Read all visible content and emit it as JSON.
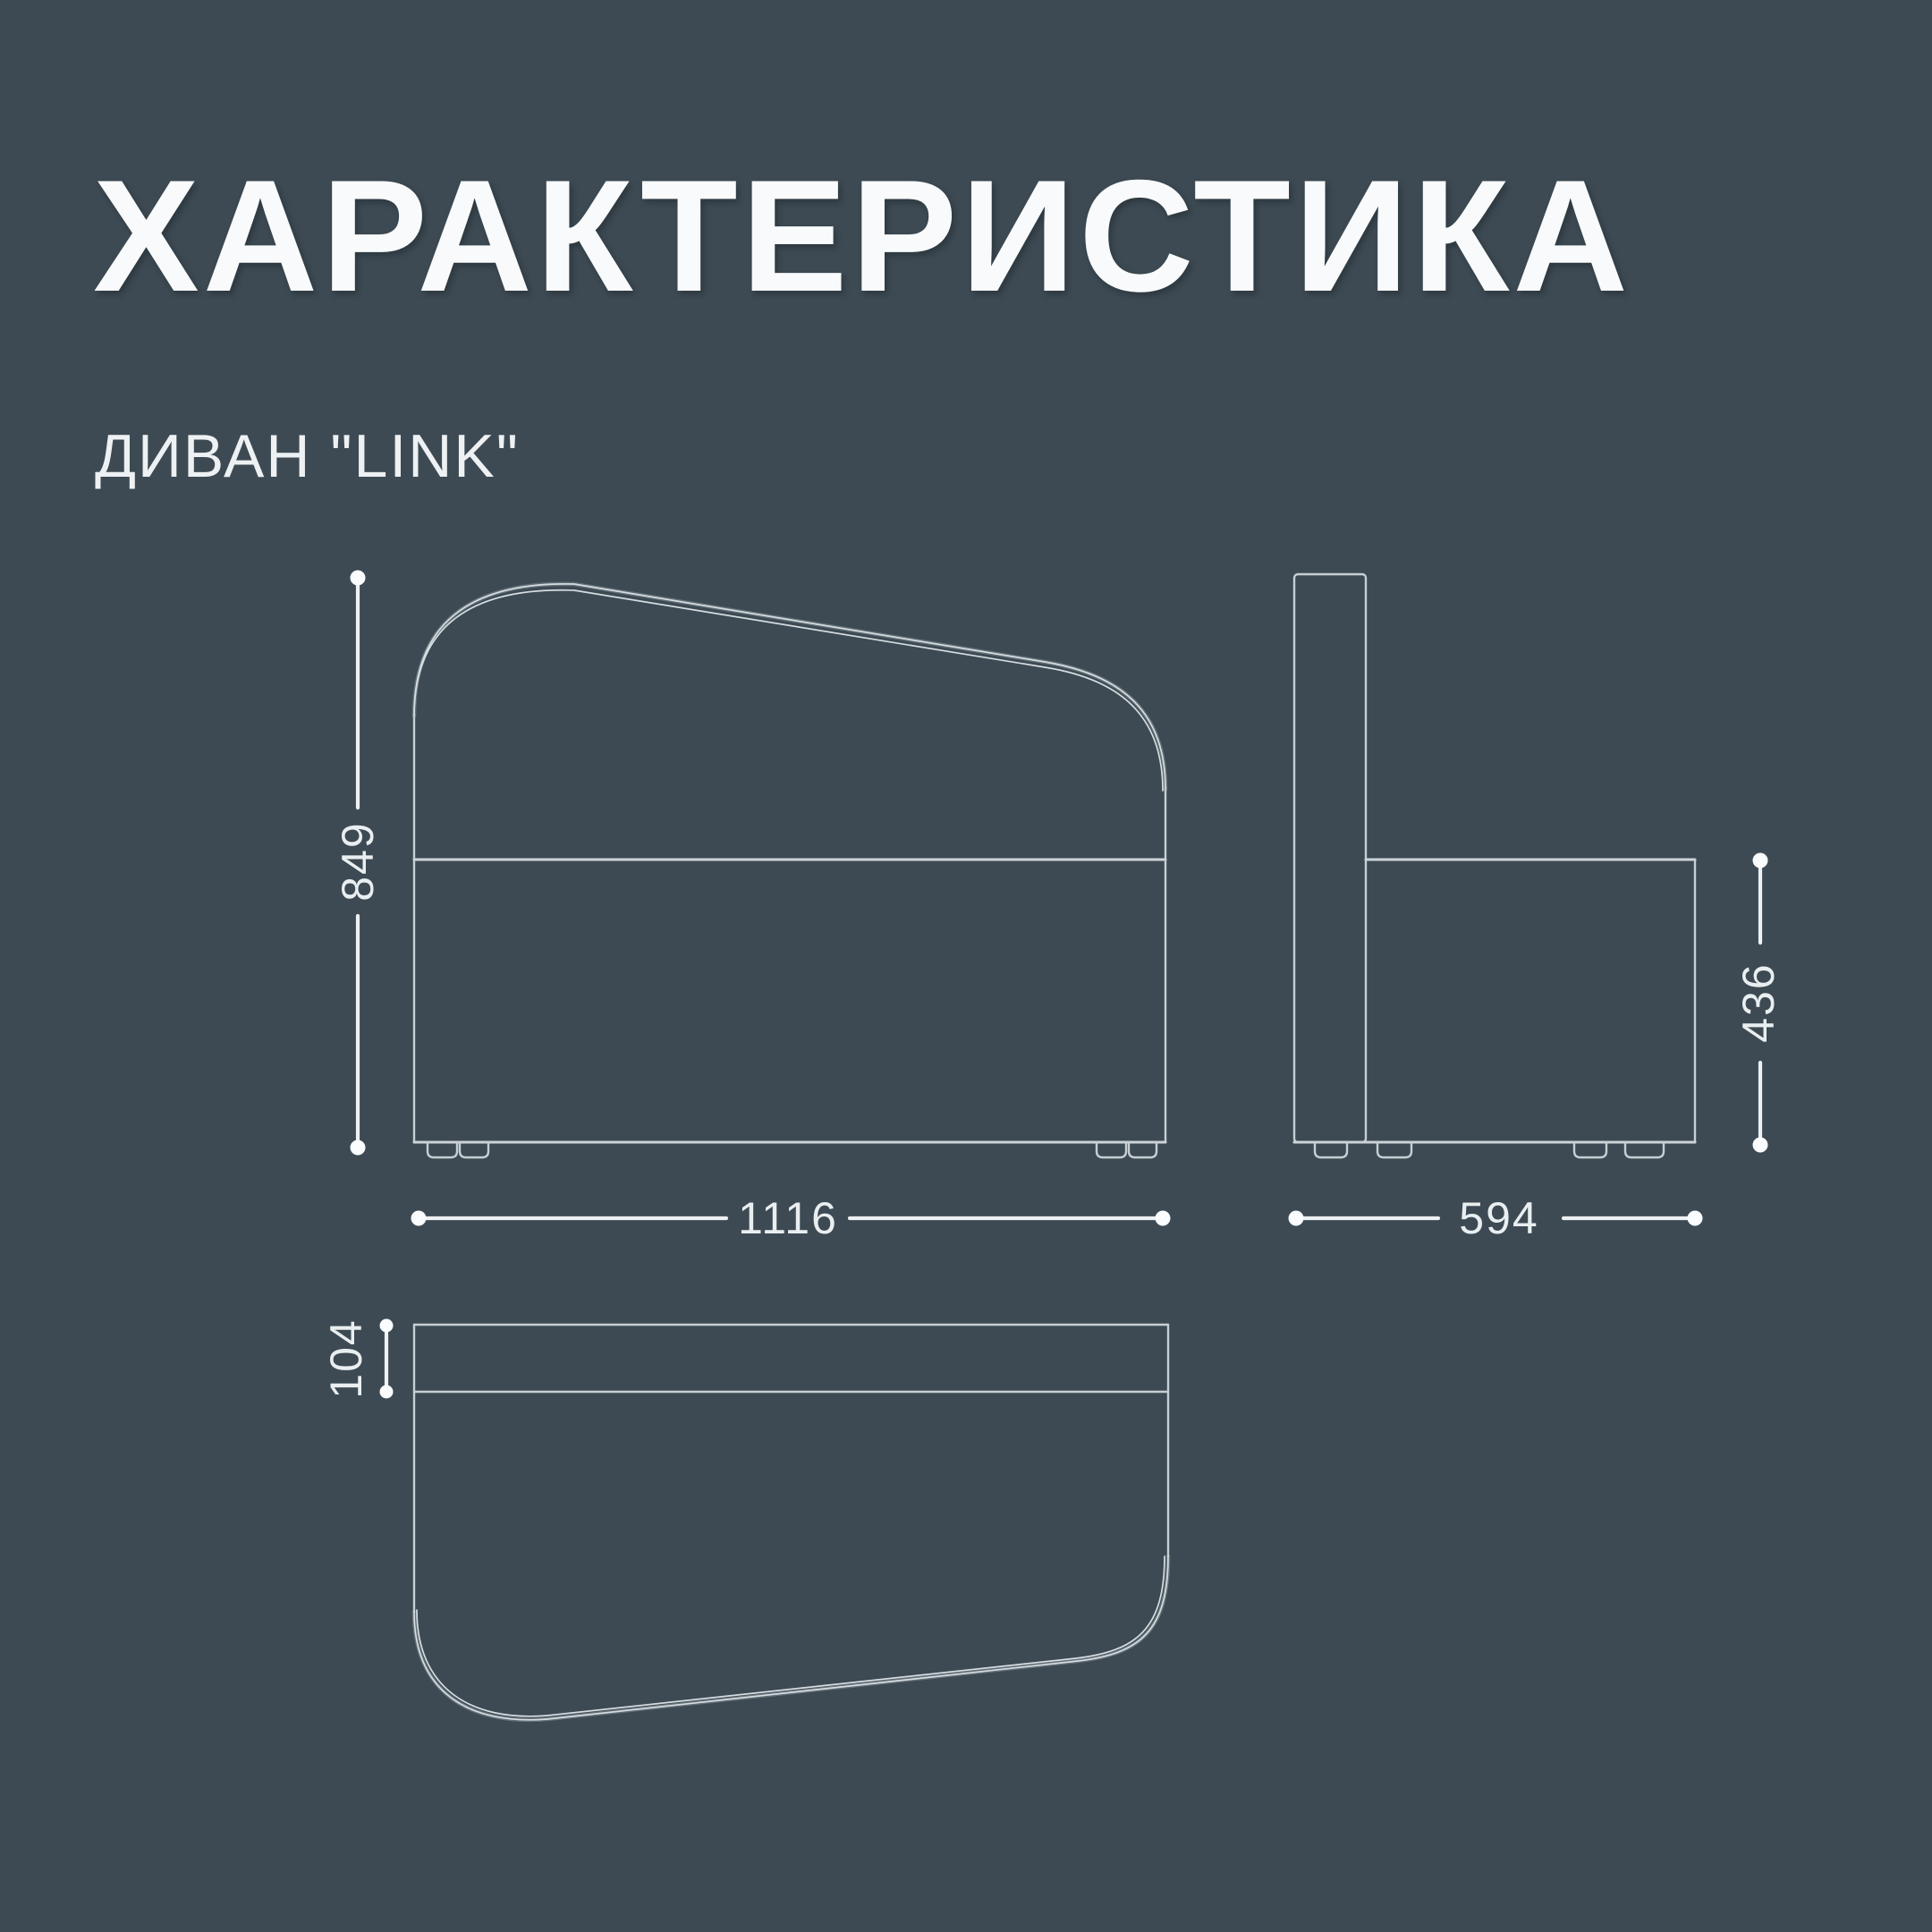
{
  "header": {
    "title": "ХАРАКТЕРИСТИКА",
    "product": "ДИВАН \"LINK\""
  },
  "diagram": {
    "type": "furniture-dimension-drawing",
    "views": {
      "front": "front-view",
      "side": "side-view",
      "top": "top-view"
    },
    "dimensions": {
      "height": "849",
      "width": "1116",
      "depth": "594",
      "seat_height": "436",
      "backrest_depth": "104"
    }
  },
  "colors": {
    "background": "#3d4a53",
    "outline": "#c7cfd4",
    "dimension": "#edf1f3",
    "text": "#f8fafb"
  }
}
